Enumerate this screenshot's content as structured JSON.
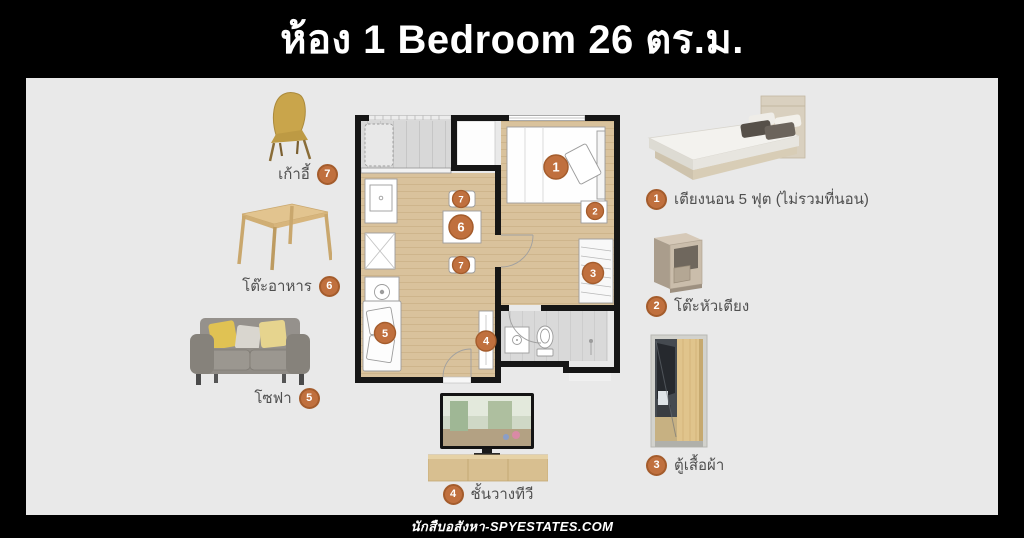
{
  "title": "ห้อง 1 Bedroom 26 ตร.ม.",
  "footer": "นักสืบอสังหา-SPYESTATES.COM",
  "legend_left": [
    {
      "num": "7",
      "label": "เก้าอี้"
    },
    {
      "num": "6",
      "label": "โต๊ะอาหาร"
    },
    {
      "num": "5",
      "label": "โซฟา"
    }
  ],
  "legend_right": [
    {
      "num": "1",
      "label": "เตียงนอน 5 ฟุต (ไม่รวมที่นอน)"
    },
    {
      "num": "2",
      "label": "โต๊ะหัวเตียง"
    },
    {
      "num": "3",
      "label": "ตู้เสื้อผ้า"
    }
  ],
  "legend_bottom": [
    {
      "num": "4",
      "label": "ชั้นวางทีวี"
    }
  ],
  "floorplan": {
    "markers": {
      "bed": "1",
      "bedside": "2",
      "wardrobe": "3",
      "tv": "4",
      "sofa": "5",
      "table": "6",
      "chair_top": "7",
      "chair_bottom": "7"
    }
  },
  "colors": {
    "accent_badge": "#c0703e",
    "panel_bg": "#e9e9e9",
    "page_bg": "#000000",
    "wood_floor": "#d9c29c"
  }
}
